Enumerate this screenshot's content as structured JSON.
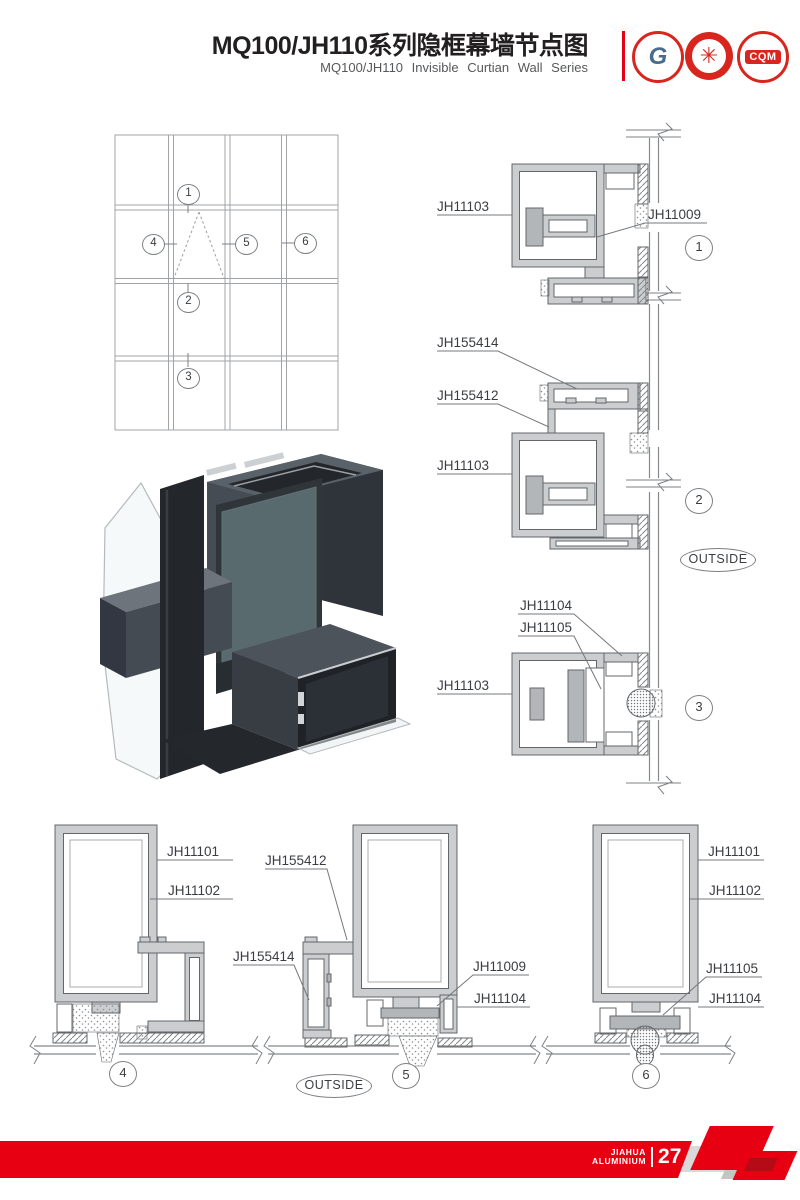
{
  "page": {
    "width": 800,
    "height": 1200,
    "background": "#ffffff"
  },
  "header": {
    "title": "MQ100/JH110系列隐框幕墙节点图",
    "subtitle": "MQ100/JH110 Invisible Curtian Wall Series",
    "accent_color": "#e60012",
    "logos": [
      {
        "name": "gb-design-institute-logo",
        "monogram": "G"
      },
      {
        "name": "quality-star-logo",
        "monogram": "✳"
      },
      {
        "name": "cqm-certification-logo",
        "monogram": "CQM"
      }
    ]
  },
  "elevation": {
    "callouts": [
      "1",
      "2",
      "3",
      "4",
      "5",
      "6"
    ]
  },
  "vertical_details": {
    "outside_label": "OUTSIDE",
    "items": [
      {
        "number": "1",
        "labels": [
          "JH11103",
          "JH11009"
        ]
      },
      {
        "number": "2",
        "labels": [
          "JH155414",
          "JH155412",
          "JH11103"
        ]
      },
      {
        "number": "3",
        "labels": [
          "JH11104",
          "JH11105",
          "JH11103"
        ]
      }
    ]
  },
  "horizontal_details": {
    "outside_label": "OUTSIDE",
    "items": [
      {
        "number": "4",
        "labels": [
          "JH11101",
          "JH11102"
        ]
      },
      {
        "number": "5",
        "labels": [
          "JH155412",
          "JH155414",
          "JH11009",
          "JH11104"
        ]
      },
      {
        "number": "6",
        "labels": [
          "JH11101",
          "JH11102",
          "JH11105",
          "JH11104"
        ]
      }
    ]
  },
  "footer": {
    "brand_line1": "JIAHUA",
    "brand_line2": "ALUMINIUM",
    "page_number": "27",
    "bar_color": "#e60012"
  }
}
